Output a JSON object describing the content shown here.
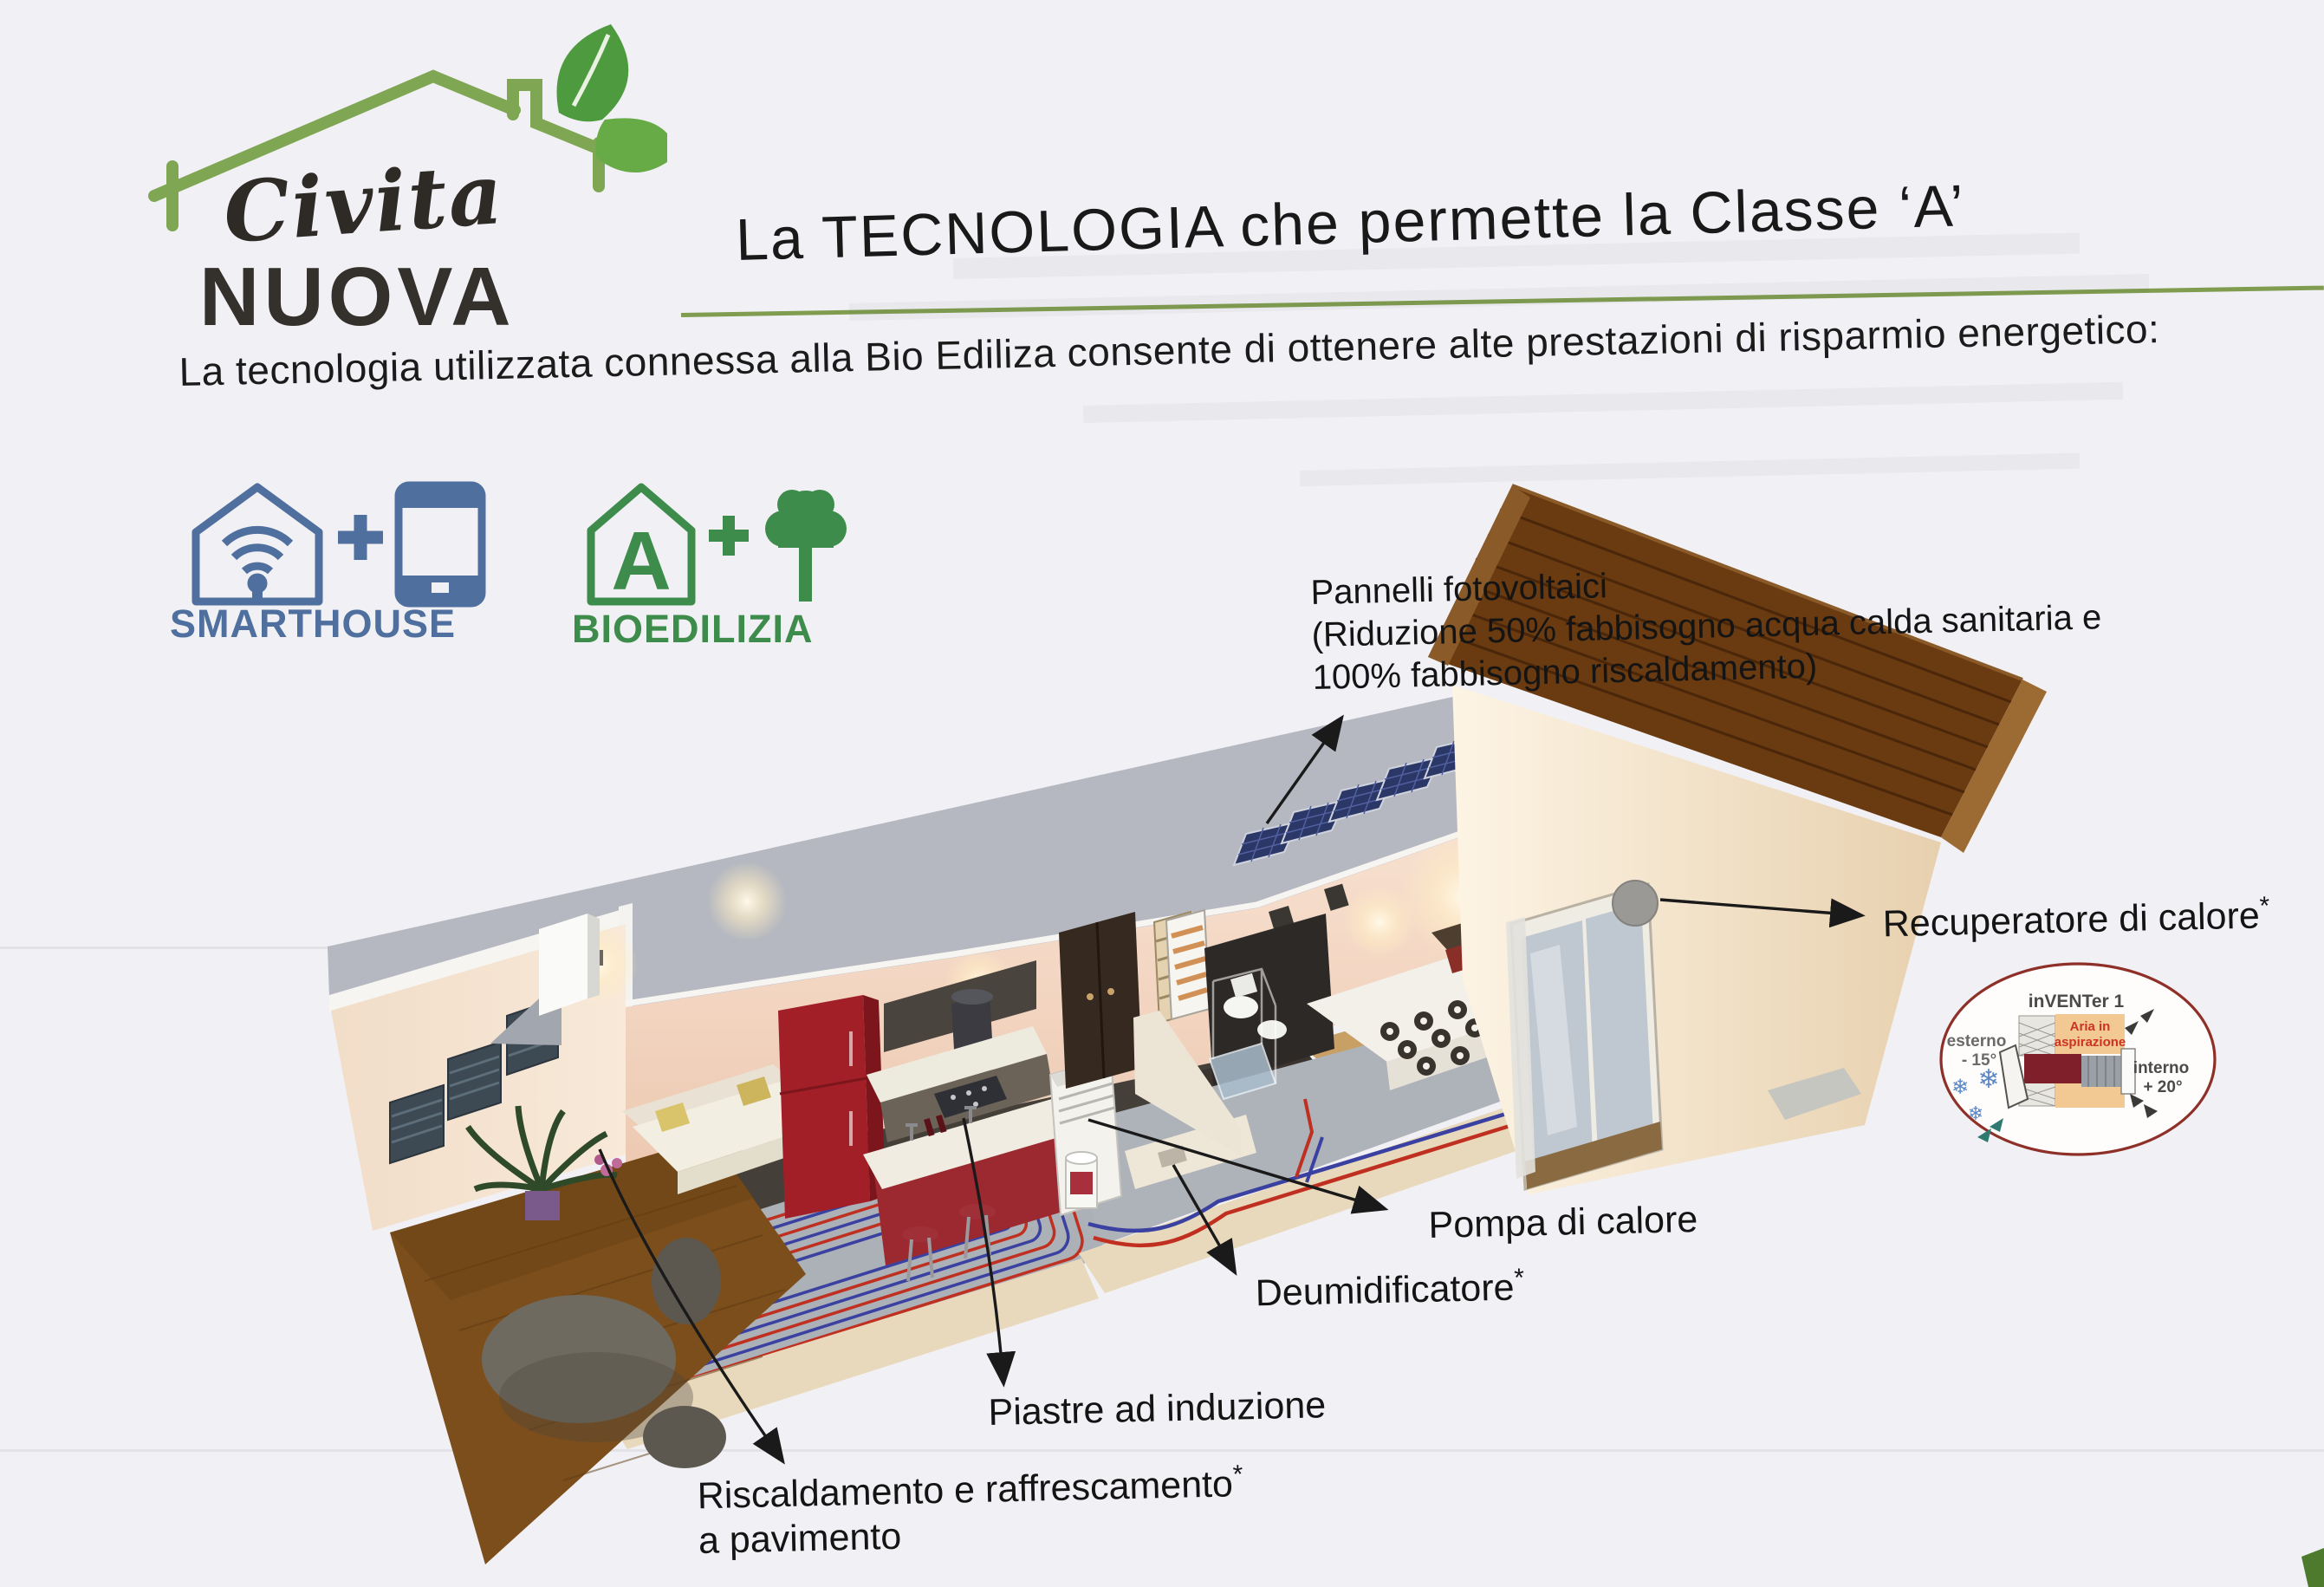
{
  "page": {
    "kind": "scanned brochure page",
    "language": "it",
    "background": "#f1f0f4"
  },
  "logo": {
    "name_line1": "Civita",
    "name_line2": "NUOVA",
    "brand_green": "#6fa04e",
    "leaf_green": "#4e9a3e"
  },
  "header": {
    "title": "La TECNOLOGIA che permette la Classe ‘A’",
    "underline_color": "#7f9c4f"
  },
  "intro": {
    "text": "La tecnologia utilizzata connessa alla Bio Ediliza consente di ottenere alte prestazioni di risparmio energetico:"
  },
  "badges": [
    {
      "label": "SMARTHOUSE",
      "color": "#4f709e",
      "icons": [
        "wifi-house-icon",
        "plus-sign",
        "smartphone-icon"
      ]
    },
    {
      "label": "BIOEDILIZIA",
      "color": "#3e8c4b",
      "house_letter": "A",
      "icons": [
        "class-a-house-icon",
        "plus-sign",
        "tree-icon"
      ]
    }
  ],
  "callouts": {
    "pannelli": {
      "title": "Pannelli fotovoltaici",
      "detail_line1": "(Riduzione 50% fabbisogno acqua calda sanitaria e",
      "detail_line2": "100% fabbisogno riscaldamento)"
    },
    "recuperatore": {
      "label": "Recuperatore di calore",
      "footnote_mark": "*"
    },
    "pompa": {
      "label": "Pompa di calore"
    },
    "deumidificatore": {
      "label": "Deumidificatore",
      "footnote_mark": "*"
    },
    "piastre": {
      "label": "Piastre ad induzione"
    },
    "riscaldamento": {
      "label_line1": "Riscaldamento e raffrescamento",
      "footnote_mark": "*",
      "label_line2": "a pavimento"
    }
  },
  "inset_diagram": {
    "title": "inVENTer 1",
    "outside_label": "esterno",
    "outside_temp": "- 15°",
    "inside_label": "interno",
    "inside_temp": "+ 20°",
    "airflow_label_line1": "Aria in",
    "airflow_label_line2": "aspirazione",
    "snowflake_icon": "❄",
    "ring_color": "#8e2f28"
  },
  "colors": {
    "heating_pipe_red": "#c03020",
    "cooling_pipe_blue": "#3a41a0",
    "roof_tile_brown": "#6a3a10",
    "solar_panel_blue": "#2b3766",
    "wall_cream": "#f4e3d0",
    "corner_mark_green": "#4d7a2d"
  }
}
